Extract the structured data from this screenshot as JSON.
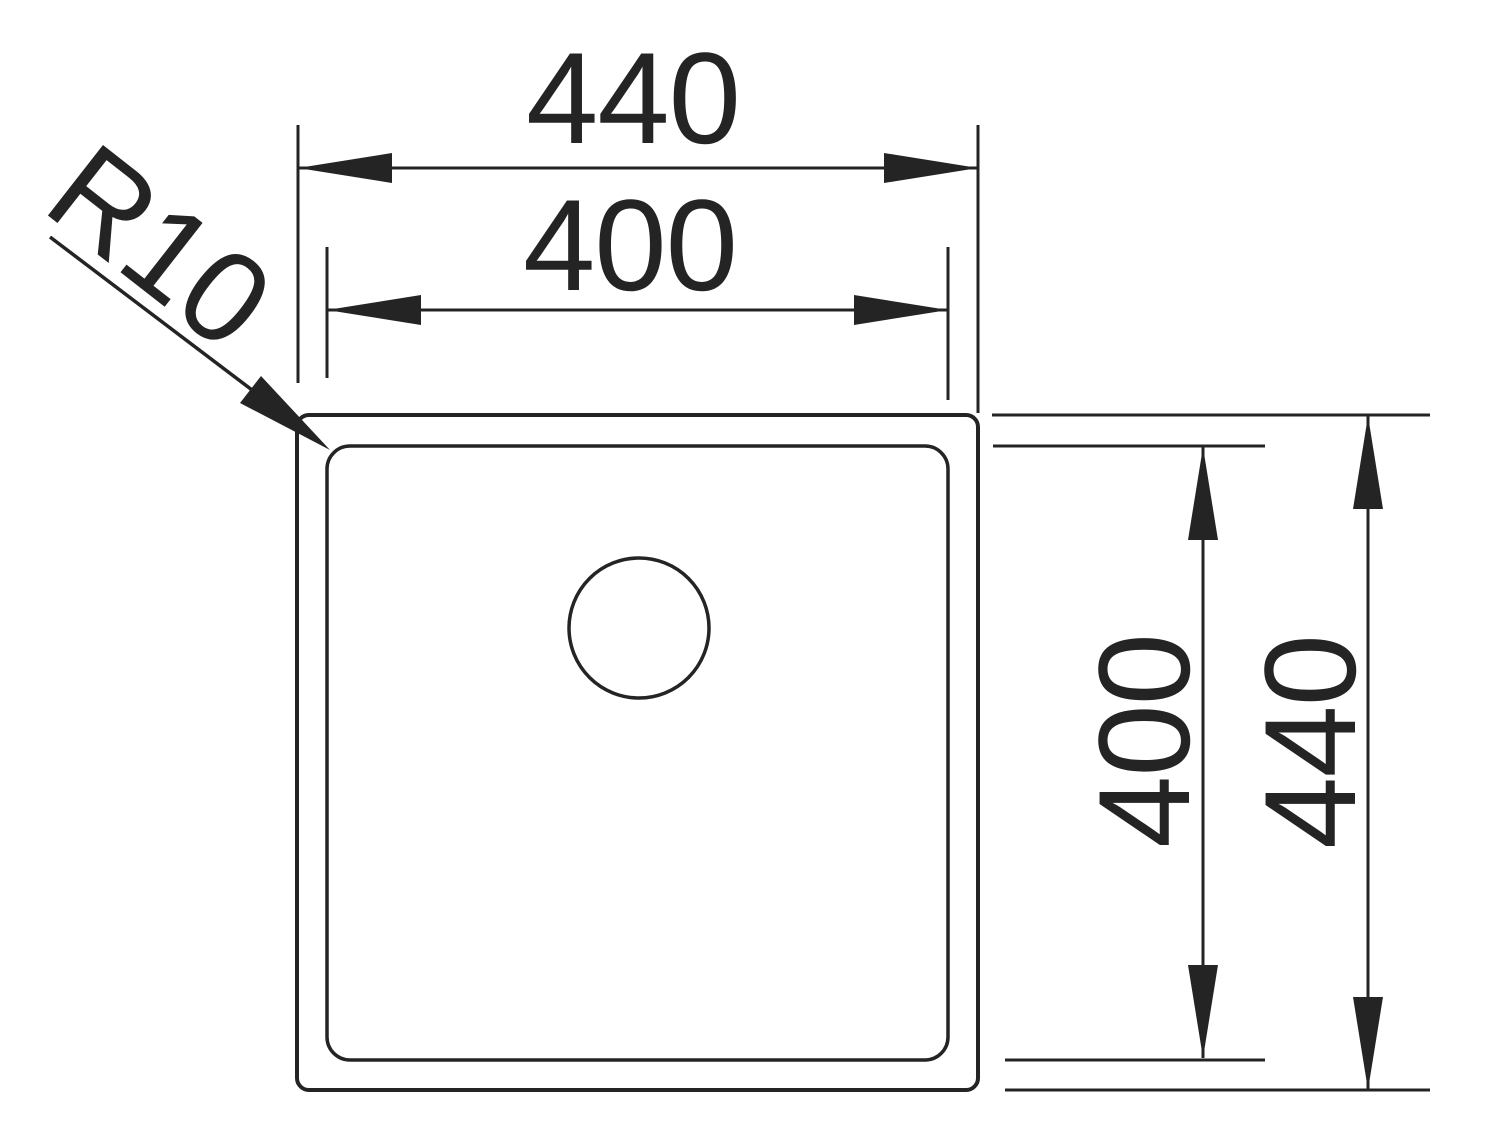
{
  "page": {
    "background": "#ffffff",
    "ink_color": "#242424"
  },
  "drawing": {
    "kind": "technical-drawing-top-view",
    "subject": "square-sink-with-drain",
    "dimensions": {
      "top_outer_width": {
        "value": "440"
      },
      "top_inner_width": {
        "value": "400"
      },
      "right_inner_height": {
        "value": "400"
      },
      "right_outer_height": {
        "value": "440"
      }
    },
    "radius_callout": {
      "label": "R10"
    }
  }
}
